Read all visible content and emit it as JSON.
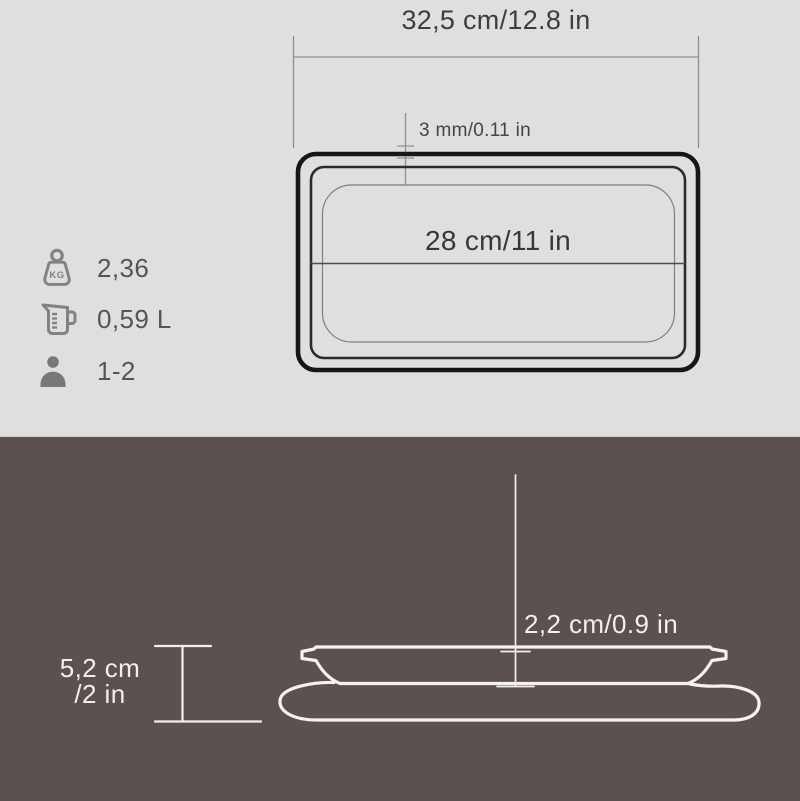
{
  "top_view": {
    "width_label": "32,5 cm/12.8 in",
    "wall_label": "3 mm/0.11 in",
    "inner_label": "28 cm/11 in"
  },
  "specs": {
    "weight": {
      "value": "2,36",
      "badge": "KG",
      "icon": "weight-kg-icon"
    },
    "volume": {
      "value": "0,59 L",
      "icon": "measuring-jug-icon"
    },
    "servings": {
      "value": "1-2",
      "icon": "person-icon"
    }
  },
  "side_view": {
    "depth_label": "2,2 cm/0.9 in",
    "height_label_line1": "5,2 cm",
    "height_label_line2": "/2 in"
  },
  "colors": {
    "top_background": "#e0dfde",
    "bottom_background": "#5b5250",
    "pan_outline_dark": "#161616",
    "dimension_line_gray": "#8f8f8f",
    "line_light": "#f5f2ef",
    "text_dark": "#3e3e3e",
    "text_light": "#f2efec",
    "icon_gray": "#828282"
  }
}
